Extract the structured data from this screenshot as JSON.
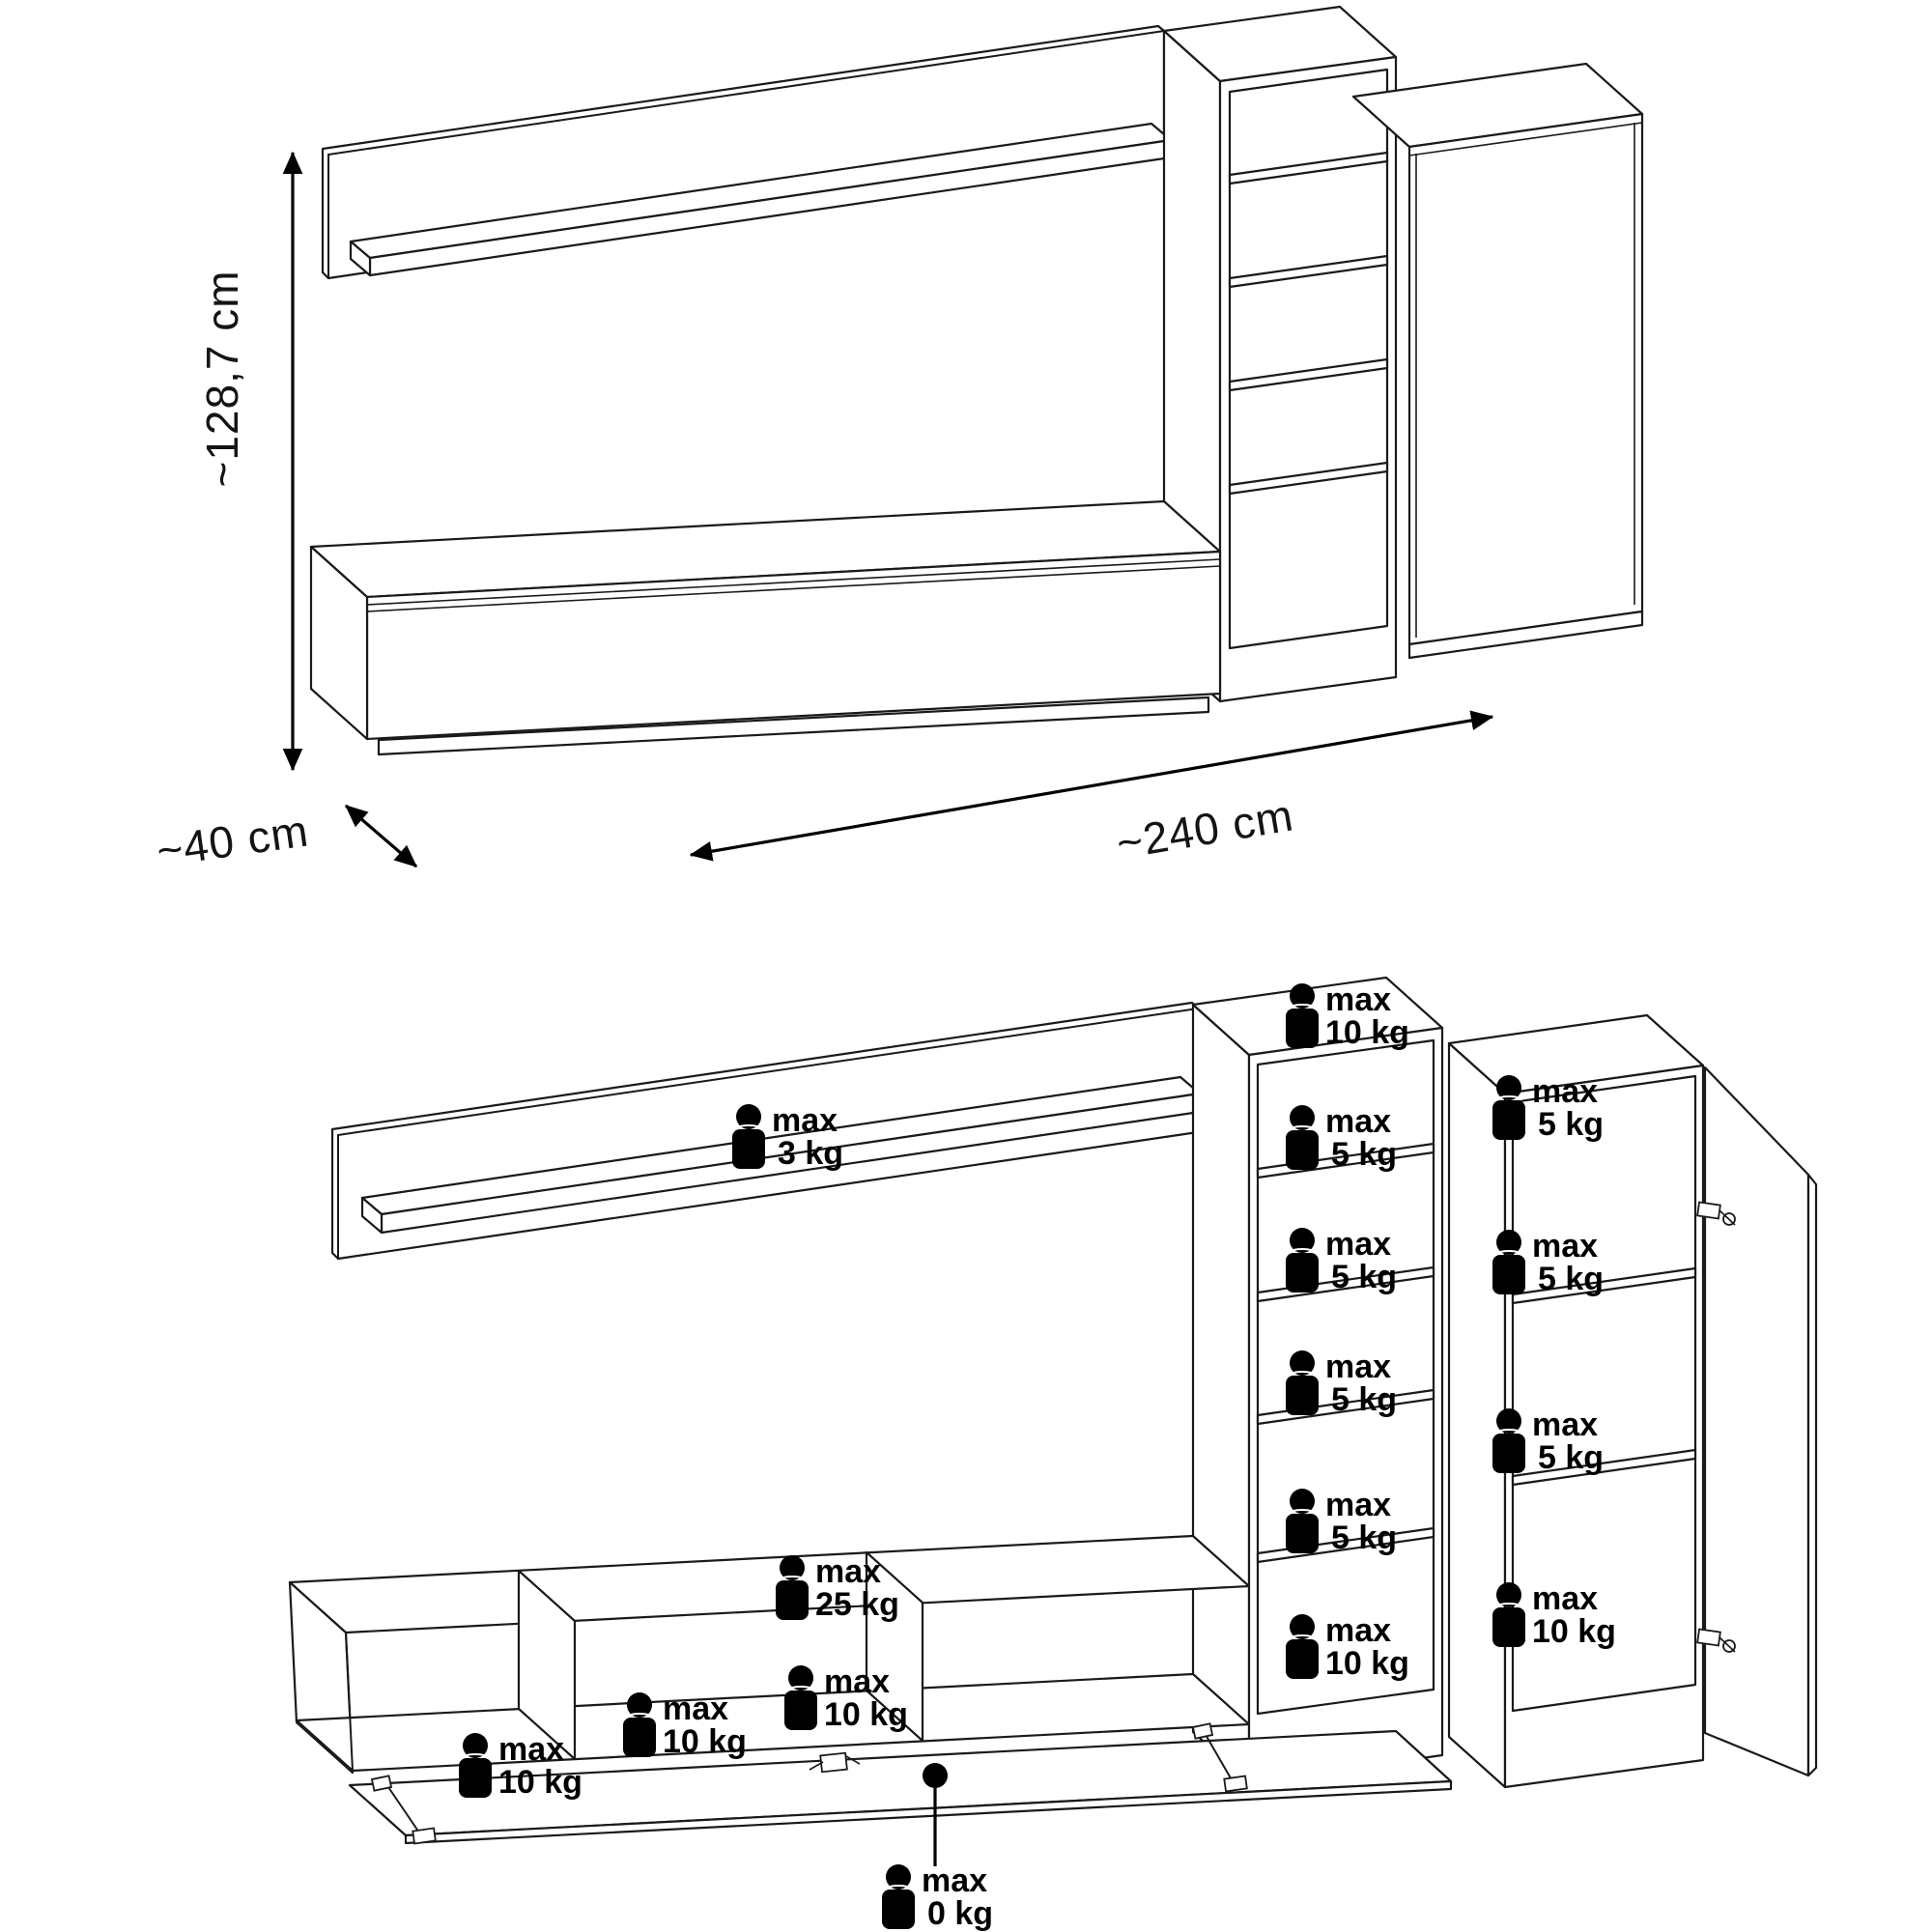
{
  "dimensions": {
    "height": "~128,7 cm",
    "depth": "~40 cm",
    "width": "~240 cm"
  },
  "weights": {
    "wall_shelf": {
      "max": "max",
      "value": "3 kg"
    },
    "tower_top": {
      "max": "max",
      "value": "10 kg"
    },
    "tower_shelf_1": {
      "max": "max",
      "value": "5 kg"
    },
    "tower_shelf_2": {
      "max": "max",
      "value": "5 kg"
    },
    "tower_shelf_3": {
      "max": "max",
      "value": "5 kg"
    },
    "tower_shelf_4": {
      "max": "max",
      "value": "5 kg"
    },
    "tower_bottom": {
      "max": "max",
      "value": "10 kg"
    },
    "cabinet_top": {
      "max": "max",
      "value": "5 kg"
    },
    "cabinet_shelf_1": {
      "max": "max",
      "value": "5 kg"
    },
    "cabinet_shelf_2": {
      "max": "max",
      "value": "5 kg"
    },
    "cabinet_bottom": {
      "max": "max",
      "value": "10 kg"
    },
    "tv_stand_top": {
      "max": "max",
      "value": "25 kg"
    },
    "tv_stand_left": {
      "max": "max",
      "value": "10 kg"
    },
    "tv_stand_middle": {
      "max": "max",
      "value": "10 kg"
    },
    "tv_stand_right": {
      "max": "max",
      "value": "10 kg"
    },
    "tv_stand_flap": {
      "max": "max",
      "value": "0 kg"
    }
  },
  "colors": {
    "line": "#1a1a1a",
    "label": "#000000",
    "background": "#ffffff"
  }
}
